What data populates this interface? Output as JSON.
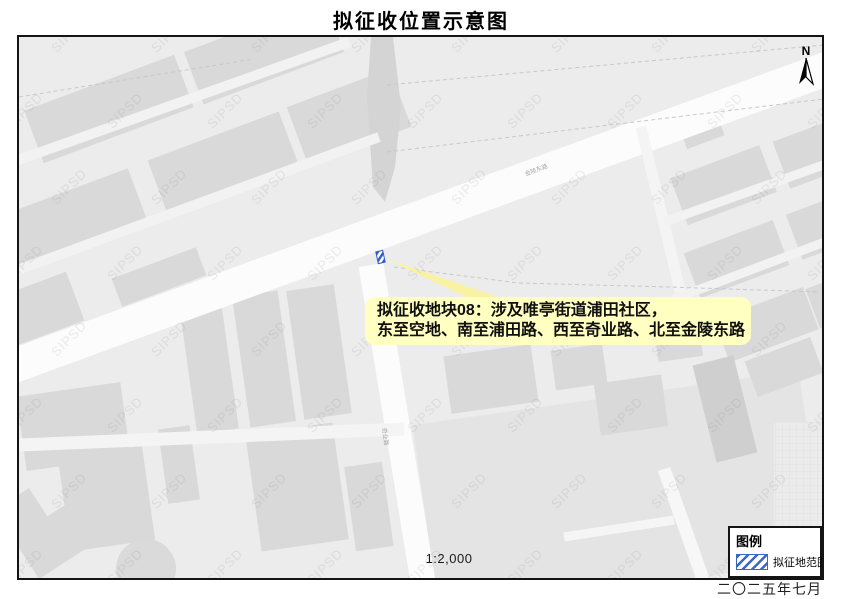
{
  "title": "拟征收位置示意图",
  "map": {
    "watermark_text": "SIPSD",
    "north_label": "N",
    "scale_label": "1:2,000",
    "road_labels": {
      "north_road": "金陵东路",
      "west_road": "奇业路"
    },
    "callout": {
      "line1": "拟征收地块08：涉及唯亭街道浦田社区，",
      "line2": "东至空地、南至浦田路、西至奇业路、北至金陵东路"
    }
  },
  "legend": {
    "title": "图例",
    "items": [
      {
        "label": "拟征地范围",
        "swatch": "blue-diagonal-hatch"
      }
    ]
  },
  "footer": {
    "date": "二〇二五年七月"
  },
  "colors": {
    "map_background": "#ececec",
    "building_fill": "#d9d9d9",
    "road_fill": "#fcfcfc",
    "callout_yellow": "#ffffc2",
    "parcel_blue": "#2e5fc7",
    "frame_border": "#141414"
  }
}
